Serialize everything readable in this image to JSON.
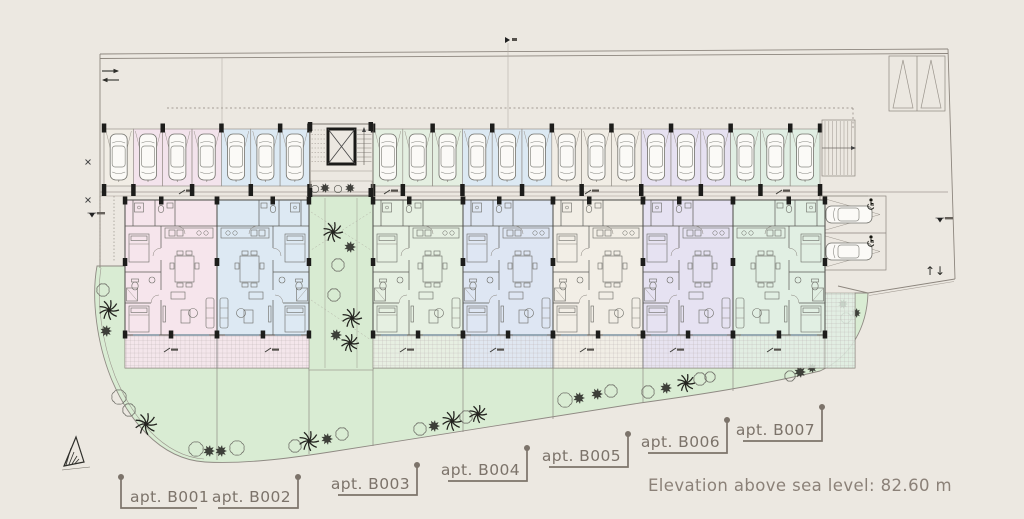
{
  "texts": {
    "elevation_note": "Elevation above sea level: 82.60 m",
    "updown_arrows": "↑↓"
  },
  "colors": {
    "background": "#ece8e1",
    "garden": "#d9ecd3",
    "courtyard": "#d8ebd2",
    "label": "#7c736a",
    "note": "#8b8178",
    "line": "#8d867e",
    "wall": "#4a4a46",
    "column": "#1d1d1b",
    "plant_dark": "#30302b",
    "car_body": "#fbfaf7"
  },
  "units": [
    {
      "id": "B001",
      "label": "apt. B001",
      "x": 125,
      "w": 92,
      "fill": "#f6e5ec",
      "mirrored": false
    },
    {
      "id": "B002",
      "label": "apt. B002",
      "x": 217,
      "w": 92,
      "fill": "#dde9f3",
      "mirrored": true,
      "terrace_fill": "#f6e5ec"
    },
    {
      "id": "B003",
      "label": "apt. B003",
      "x": 373,
      "w": 90,
      "fill": "#e6f0e2",
      "mirrored": false
    },
    {
      "id": "B004",
      "label": "apt. B004",
      "x": 463,
      "w": 90,
      "fill": "#dee6f3",
      "mirrored": false
    },
    {
      "id": "B005",
      "label": "apt. B005",
      "x": 553,
      "w": 90,
      "fill": "#f2eee6",
      "mirrored": false
    },
    {
      "id": "B006",
      "label": "apt. B006",
      "x": 643,
      "w": 90,
      "fill": "#e6e2f2",
      "mirrored": false
    },
    {
      "id": "B007",
      "label": "apt. B007",
      "x": 733,
      "w": 92,
      "fill": "#e1efe3",
      "mirrored": true
    }
  ],
  "callouts": [
    {
      "id": "B001",
      "text": "apt. B001",
      "dot": [
        121,
        477
      ],
      "elbow_y": 508,
      "under_to": 197,
      "anchor": "start",
      "tx": 130,
      "ty": 502
    },
    {
      "id": "B002",
      "text": "apt. B002",
      "dot": [
        298,
        477
      ],
      "elbow_y": 508,
      "under_to": 218,
      "anchor": "end",
      "tx": 291,
      "ty": 502
    },
    {
      "id": "B003",
      "text": "apt. B003",
      "dot": [
        417,
        465
      ],
      "elbow_y": 495,
      "under_to": 338,
      "anchor": "end",
      "tx": 410,
      "ty": 489
    },
    {
      "id": "B004",
      "text": "apt. B004",
      "dot": [
        527,
        448
      ],
      "elbow_y": 481,
      "under_to": 448,
      "anchor": "end",
      "tx": 520,
      "ty": 475
    },
    {
      "id": "B005",
      "text": "apt. B005",
      "dot": [
        628,
        434
      ],
      "elbow_y": 467,
      "under_to": 549,
      "anchor": "end",
      "tx": 621,
      "ty": 461
    },
    {
      "id": "B006",
      "text": "apt. B006",
      "dot": [
        727,
        420
      ],
      "elbow_y": 453,
      "under_to": 648,
      "anchor": "end",
      "tx": 720,
      "ty": 447
    },
    {
      "id": "B007",
      "text": "apt. B007",
      "dot": [
        822,
        407
      ],
      "elbow_y": 441,
      "under_to": 743,
      "anchor": "end",
      "tx": 815,
      "ty": 435
    }
  ],
  "parking": {
    "left_bays": [
      "#f1ede5",
      "#f3e3ec",
      "#f3e3ec",
      "#f3e3ec",
      "#dce9f3",
      "#dce9f3",
      "#dce9f3"
    ],
    "right_bays": [
      "#e4efe1",
      "#e4efe1",
      "#e4efe1",
      "#dce9f3",
      "#dce9f3",
      "#dce9f3",
      "#f1ede5",
      "#f1ede5",
      "#f1ede5",
      "#e6e1f1",
      "#e6e1f1",
      "#e6e1f1",
      "#e0eee3",
      "#e0eee3",
      "#e0eee3"
    ],
    "accessible_bays": 2
  },
  "icons": {
    "car-icon": "top-view sedan",
    "wheelchair-icon": "accessible parking symbol",
    "elevator-icon": "shaft with X",
    "stairs-icon": "treads",
    "ramp-icon": "double triangle",
    "palm-icon": "palm tree",
    "bush-icon": "scalloped shrub",
    "shrub-icon": "dark dense shrub",
    "north-arrow-icon": "hatched triangle",
    "updown-arrows-icon": "circulation arrows",
    "level-marker-icon": "inverted triangle benchmark"
  }
}
